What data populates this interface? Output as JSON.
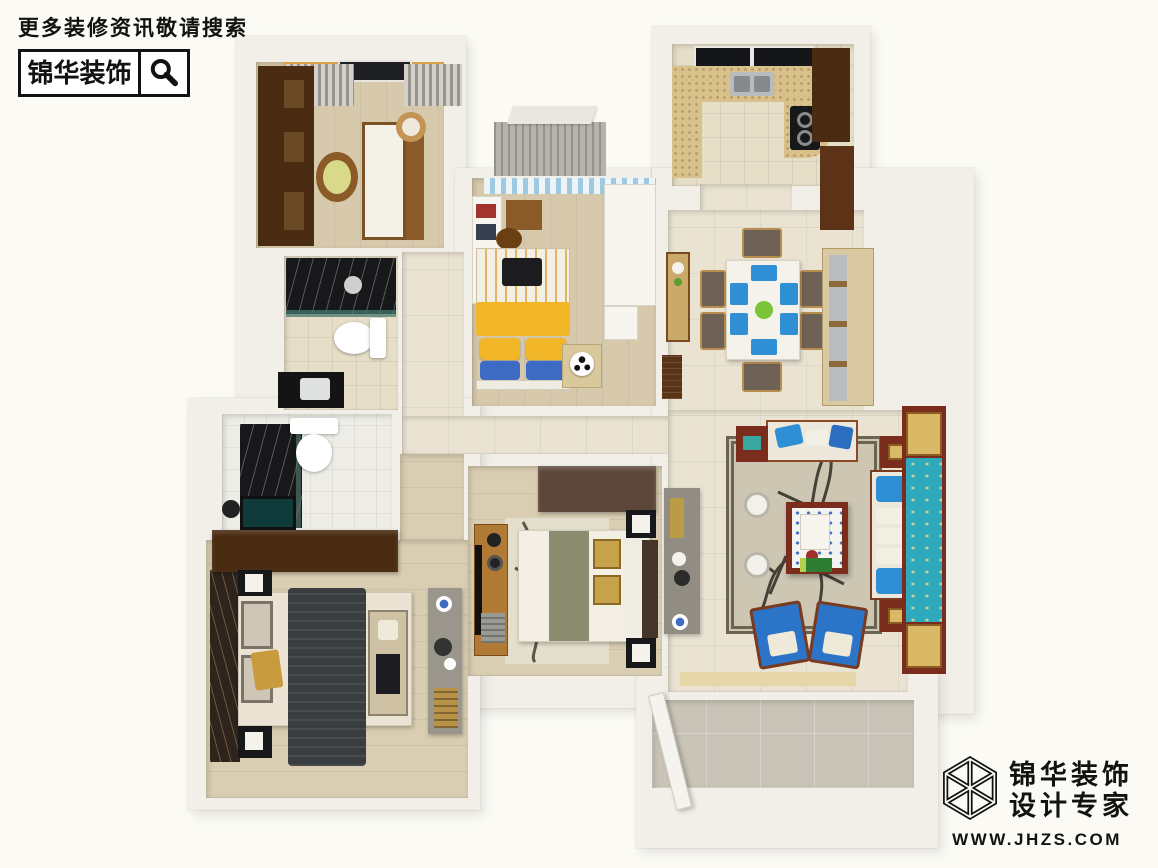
{
  "watermark_top_left": {
    "slogan": "更多装修资讯敬请搜索",
    "brand": "锦华装饰",
    "icon": "magnifier-icon"
  },
  "watermark_bottom_right": {
    "brand_line1": "锦华装饰",
    "brand_line2": "设计专家",
    "website": "WWW.JHZS.COM",
    "icon": "cube-wireframe-logo-icon"
  },
  "colors": {
    "bg": "#fbfaf4",
    "wall": "#f1efe8",
    "ink": "#121212",
    "woodA": "#d7c9ab",
    "woodB": "#d9cdb2",
    "marble": "#eae3d2",
    "tileBeige": "#e6dec7",
    "tileWhite": "#edece6",
    "tileGray": "#c9c4b7",
    "darkwood": "#4a2c12",
    "midwood": "#8a5a28",
    "redwood": "#7a2d1c",
    "gold": "#d9b965",
    "turquoise": "#2fa9bc",
    "sofawhite": "#ece8db",
    "bluechair": "#2b74c8",
    "bluepillow": "#2f8fd4",
    "yellow": "#f2b728",
    "bluebed": "#3d6ac2",
    "black": "#17181a",
    "creambed": "#ebe4d4",
    "throwgray": "#3a3d40",
    "sage": "#8b8b70",
    "rug": "#cdc6b3",
    "rugborder": "#6b6450",
    "chairgray": "#6e6156",
    "countertan": "#d8c18b"
  }
}
